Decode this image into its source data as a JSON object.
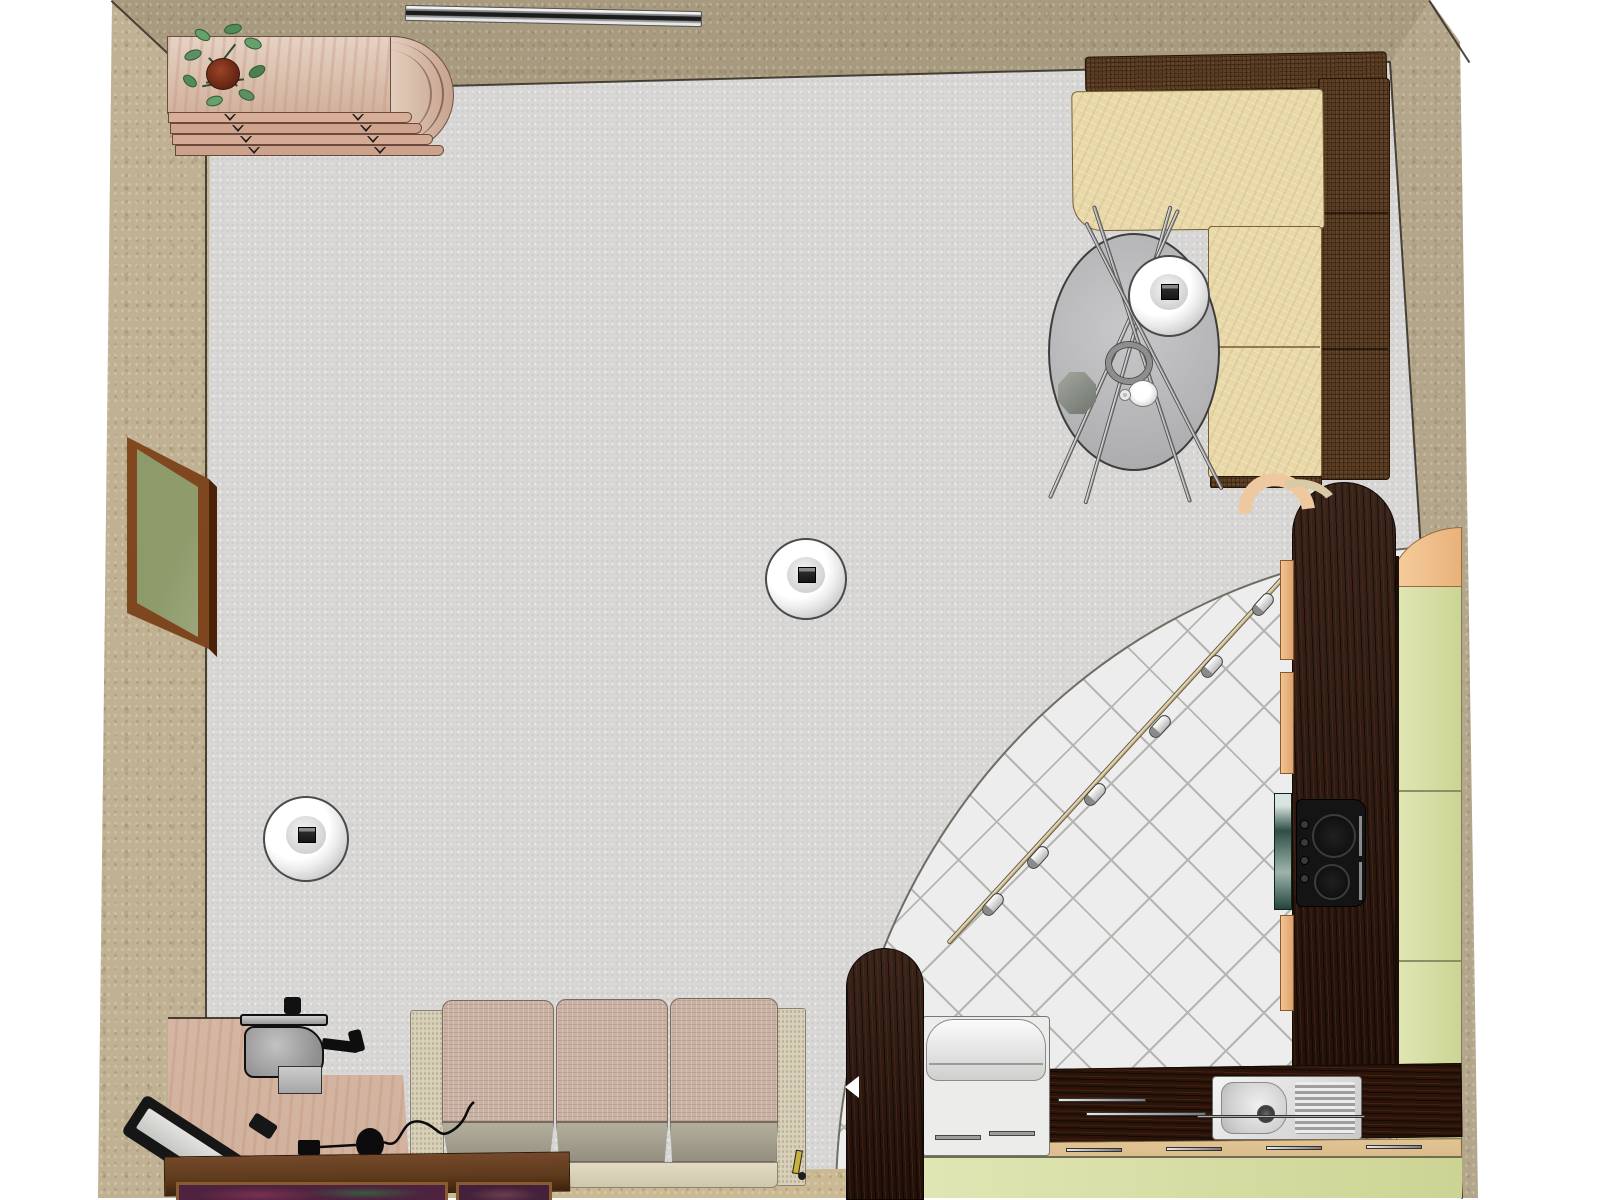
{
  "palette": {
    "background": "#ffffff",
    "wall_top": "#a79a7e",
    "wall_left": "#c0b193",
    "wall_right": "#b3a68a",
    "wall_bottom": "#cbb993",
    "floor": "#d8d7d5",
    "tile": "#ecedec",
    "tile_line": "#b5b5b2",
    "wood_pink": "#dcc0ac",
    "wenge": "#2a140a",
    "peach": "#f0c08e",
    "pale_green": "#dbe2ab",
    "sofa_seat_tan": "#e9d9a9",
    "sofa_back_brown": "#5a3c22",
    "couch_cushion": "#c9b2a3",
    "couch_seat": "#a8a292",
    "couch_arm": "#d9d0ba",
    "glass": "#bcbcbe",
    "chrome": "#cfcfcf",
    "frame_brown": "#7c451f",
    "art_olive": "#8a9868",
    "sideboard": "#5e3a1c",
    "lamp_white": "#f4f4f4",
    "steel": "#d9d9d9",
    "track_rod": "#d9cba6",
    "teal_glass": "#2e4f46",
    "tan_strip": "#d9b98b"
  },
  "scene": {
    "view": "top-down perspective render of a studio room with living area and corner kitchen",
    "areas": [
      "living-area",
      "kitchen-area"
    ],
    "pendant_lamp_count": 3,
    "track_spotlight_count": 6,
    "objects": [
      {
        "name": "chest-of-drawers",
        "desc": "curved wooden dresser with four drawers, top-left",
        "area": "living-area"
      },
      {
        "name": "potted-plant",
        "desc": "green plant in clay pot on dresser",
        "area": "living-area"
      },
      {
        "name": "chrome-wall-bar",
        "desc": "metallic bar mounted on top wall",
        "area": "living-area"
      },
      {
        "name": "corner-sofa",
        "desc": "L-shaped sofa, tan seats with dark brown back, top-right",
        "area": "living-area"
      },
      {
        "name": "round-glass-table",
        "desc": "round glass table with crossed rod legs",
        "area": "living-area"
      },
      {
        "name": "pendant-lamp-over-table",
        "desc": "white globe pendant lamp above table",
        "area": "living-area"
      },
      {
        "name": "pendant-lamp-center",
        "desc": "white globe pendant lamp, room center",
        "area": "living-area"
      },
      {
        "name": "pendant-lamp-left",
        "desc": "white globe pendant lamp, left side",
        "area": "living-area"
      },
      {
        "name": "wall-painting",
        "desc": "framed abstract painting on left wall",
        "area": "living-area"
      },
      {
        "name": "three-seat-sofa",
        "desc": "three seat sofa along bottom wall",
        "area": "living-area"
      },
      {
        "name": "writing-desk",
        "desc": "wooden desk with machine, lamp and mouse, bottom-left",
        "area": "living-area"
      },
      {
        "name": "sideboard",
        "desc": "dark wood sideboard with framed pictures, bottom edge",
        "area": "living-area"
      },
      {
        "name": "kitchen-tile-floor",
        "desc": "quarter-circle diagonal tiled kitchen floor",
        "area": "kitchen-area"
      },
      {
        "name": "track-light",
        "desc": "curved track light rail with six spotlights",
        "area": "kitchen-area"
      },
      {
        "name": "wenge-counter",
        "desc": "L-shaped dark wenge kitchen counter",
        "area": "kitchen-area"
      },
      {
        "name": "cooktop",
        "desc": "black cooktop with burners and knobs",
        "area": "kitchen-area"
      },
      {
        "name": "kitchen-sink",
        "desc": "stainless sink with drainboard and faucet",
        "area": "kitchen-area"
      },
      {
        "name": "tall-green-cabinet",
        "desc": "pale green cabinet column along right wall",
        "area": "kitchen-area"
      },
      {
        "name": "peach-cabinets",
        "desc": "peach cabinet fronts with chrome handles",
        "area": "kitchen-area"
      },
      {
        "name": "white-appliance",
        "desc": "white appliance with padded lid",
        "area": "kitchen-area"
      },
      {
        "name": "rounded-dark-column",
        "desc": "tall rounded dark wood element",
        "area": "kitchen-area"
      },
      {
        "name": "glass-octagon-decor",
        "desc": "small octagonal object on glass table",
        "area": "living-area"
      },
      {
        "name": "coffee-cup",
        "desc": "small white cup on glass table",
        "area": "living-area"
      }
    ]
  }
}
